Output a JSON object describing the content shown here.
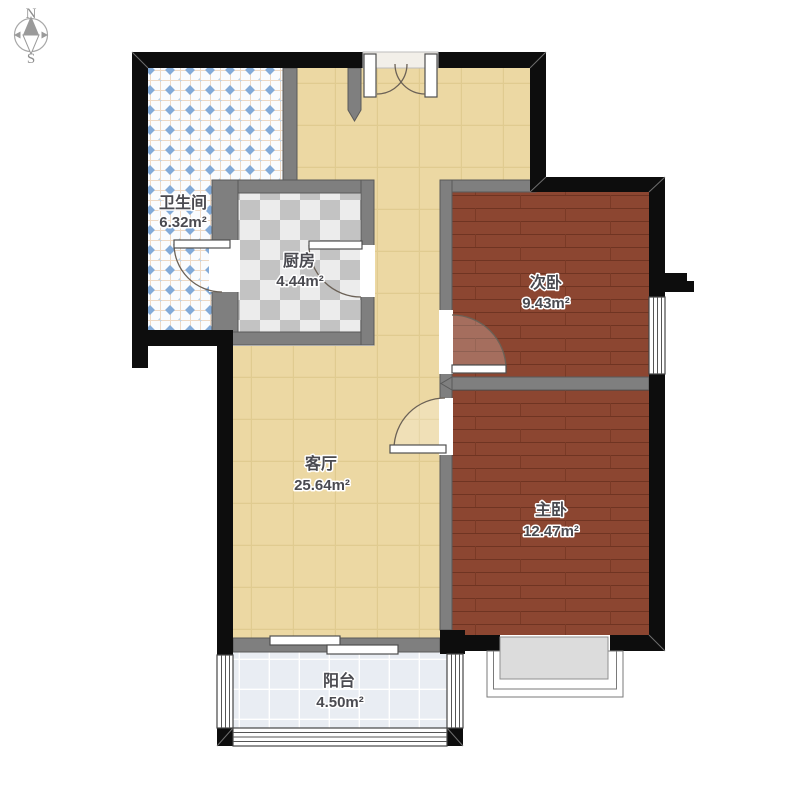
{
  "title": "apartment-floor-plan",
  "compass": {
    "north_label": "N",
    "south_label": "S"
  },
  "rooms": [
    {
      "id": "bathroom",
      "name": "卫生间",
      "area": "6.32m²"
    },
    {
      "id": "kitchen",
      "name": "厨房",
      "area": "4.44m²"
    },
    {
      "id": "secondary-bedroom",
      "name": "次卧",
      "area": "9.43m²"
    },
    {
      "id": "living-room",
      "name": "客厅",
      "area": "25.64m²"
    },
    {
      "id": "master-bedroom",
      "name": "主卧",
      "area": "12.47m²"
    },
    {
      "id": "balcony",
      "name": "阳台",
      "area": "4.50m²"
    }
  ],
  "colors": {
    "wall-black": "#0d0d0d",
    "wall-gray": "#7f7f7f",
    "wall-gray-edge": "#5a5a5a",
    "hall-floor": "#ecd8a3",
    "hall-grid": "#e0cb90",
    "wood-floor": "#8c4631",
    "wood-line": "#6f3422",
    "bath-bg": "#fafcfe",
    "bath-grid": "#eed9c4",
    "bath-diamond": "#82aad8",
    "kitchen-light": "#ececec",
    "kitchen-dark": "#c3c3c3",
    "balcony-bg": "#e9edf3",
    "balcony-grid": "#ffffff",
    "bay-fill": "#dcdcdc",
    "door-arc": "#6b6156",
    "label-color": "#4a4a50"
  }
}
